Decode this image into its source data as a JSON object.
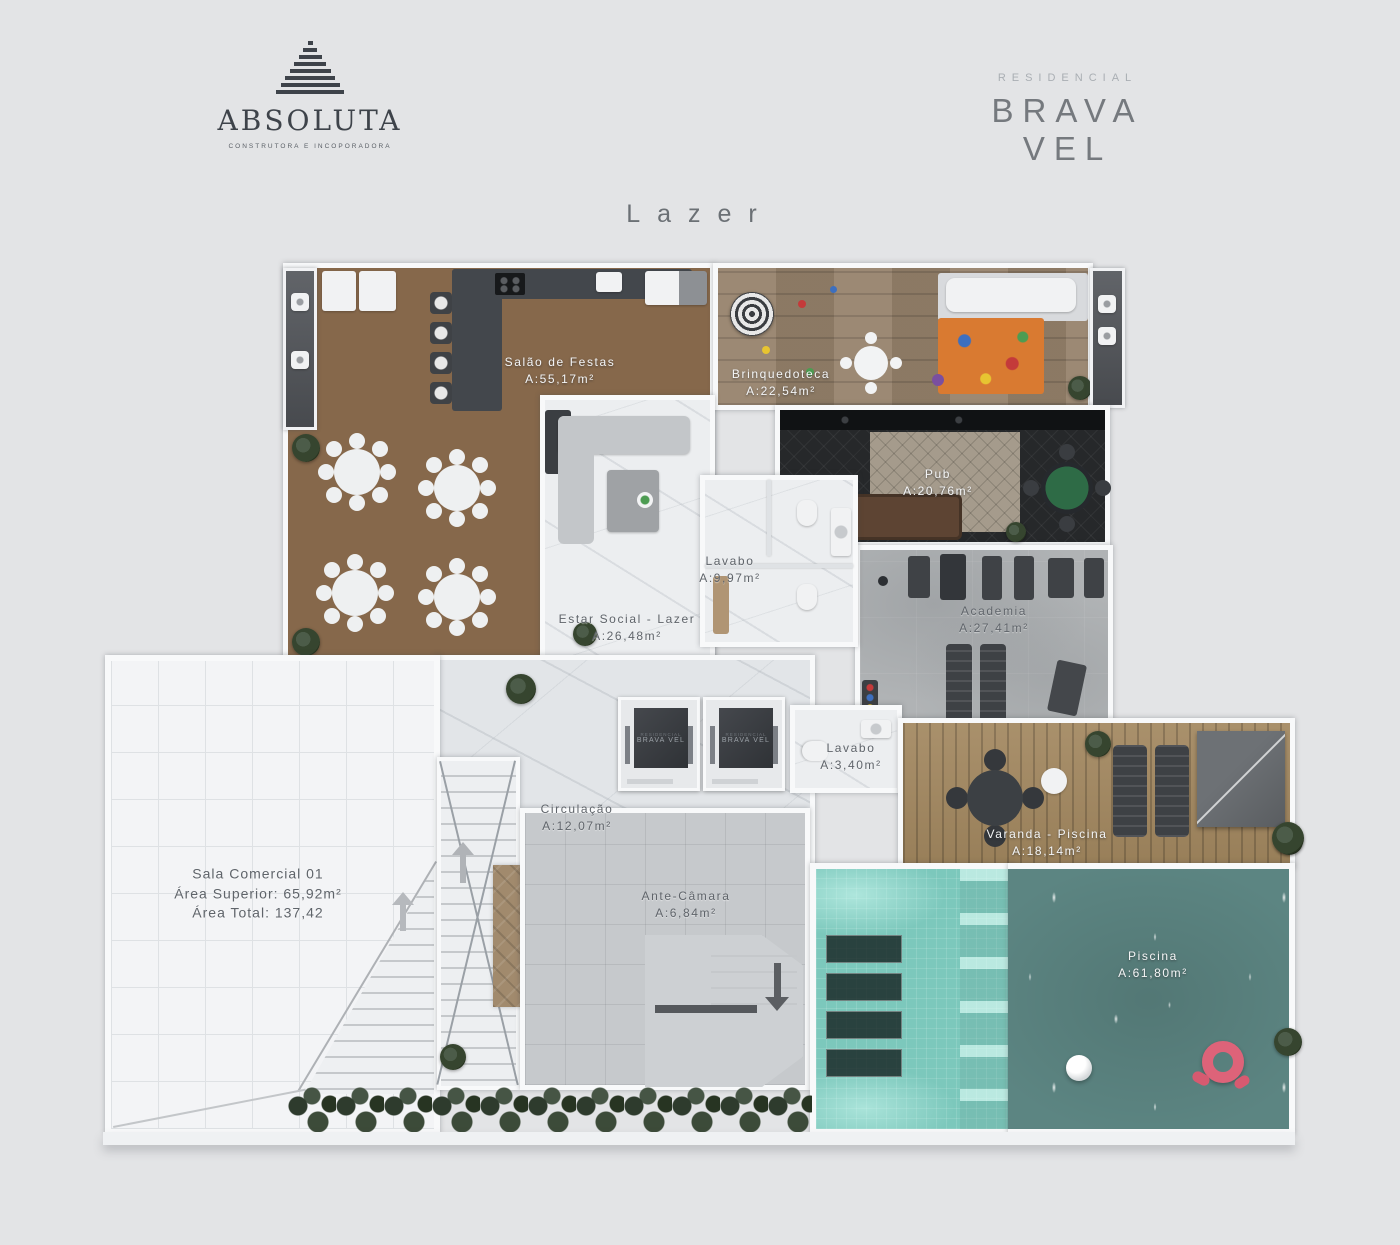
{
  "brand": {
    "name": "ABSOLUTA",
    "tagline": "CONSTRUTORA E INCOPORADORA"
  },
  "residence": {
    "category": "RESIDENCIAL",
    "name": "BRAVA VEL"
  },
  "title": "Lazer",
  "rooms": [
    {
      "name": "Salão de Festas",
      "area": "A:55,17m²"
    },
    {
      "name": "Brinquedoteca",
      "area": "A:22,54m²"
    },
    {
      "name": "Pub",
      "area": "A:20,76m²"
    },
    {
      "name": "Lavabo",
      "area": "A:9,97m²"
    },
    {
      "name": "Estar Social - Lazer",
      "area": "A:26,48m²"
    },
    {
      "name": "Academia",
      "area": "A:27,41m²"
    },
    {
      "name": "Lavabo",
      "area": "A:3,40m²"
    },
    {
      "name": "Circulação",
      "area": "A:12,07m²"
    },
    {
      "name": "Varanda - Piscina",
      "area": "A:18,14m²"
    },
    {
      "name": "Ante-Câmara",
      "area": "A:6,84m²"
    },
    {
      "name": "Piscina",
      "area": "A:61,80m²"
    }
  ],
  "commercial_room": {
    "name": "Sala Comercial 01",
    "area_superior": "Área Superior: 65,92m²",
    "area_total": "Área Total: 137,42"
  },
  "elevator": {
    "category": "RESIDENCIAL",
    "brand": "BRAVA VEL"
  },
  "colors": {
    "background": "#e3e4e6",
    "wall": "#f8f9fa",
    "wood_herringbone": "#86684b",
    "wood_plank": "#96826b",
    "marble": "#eceef0",
    "concrete": "#b0b3b5",
    "deck_wood": "#a2875f",
    "pool_shallow": "#7cc8bc",
    "pool_deep": "#5c8582",
    "pub_floor": "#26282a",
    "counter_dark": "#43474c",
    "float_pink": "#dd6379",
    "label_light": "#f4f5f6",
    "label_dark": "#5f646a"
  }
}
